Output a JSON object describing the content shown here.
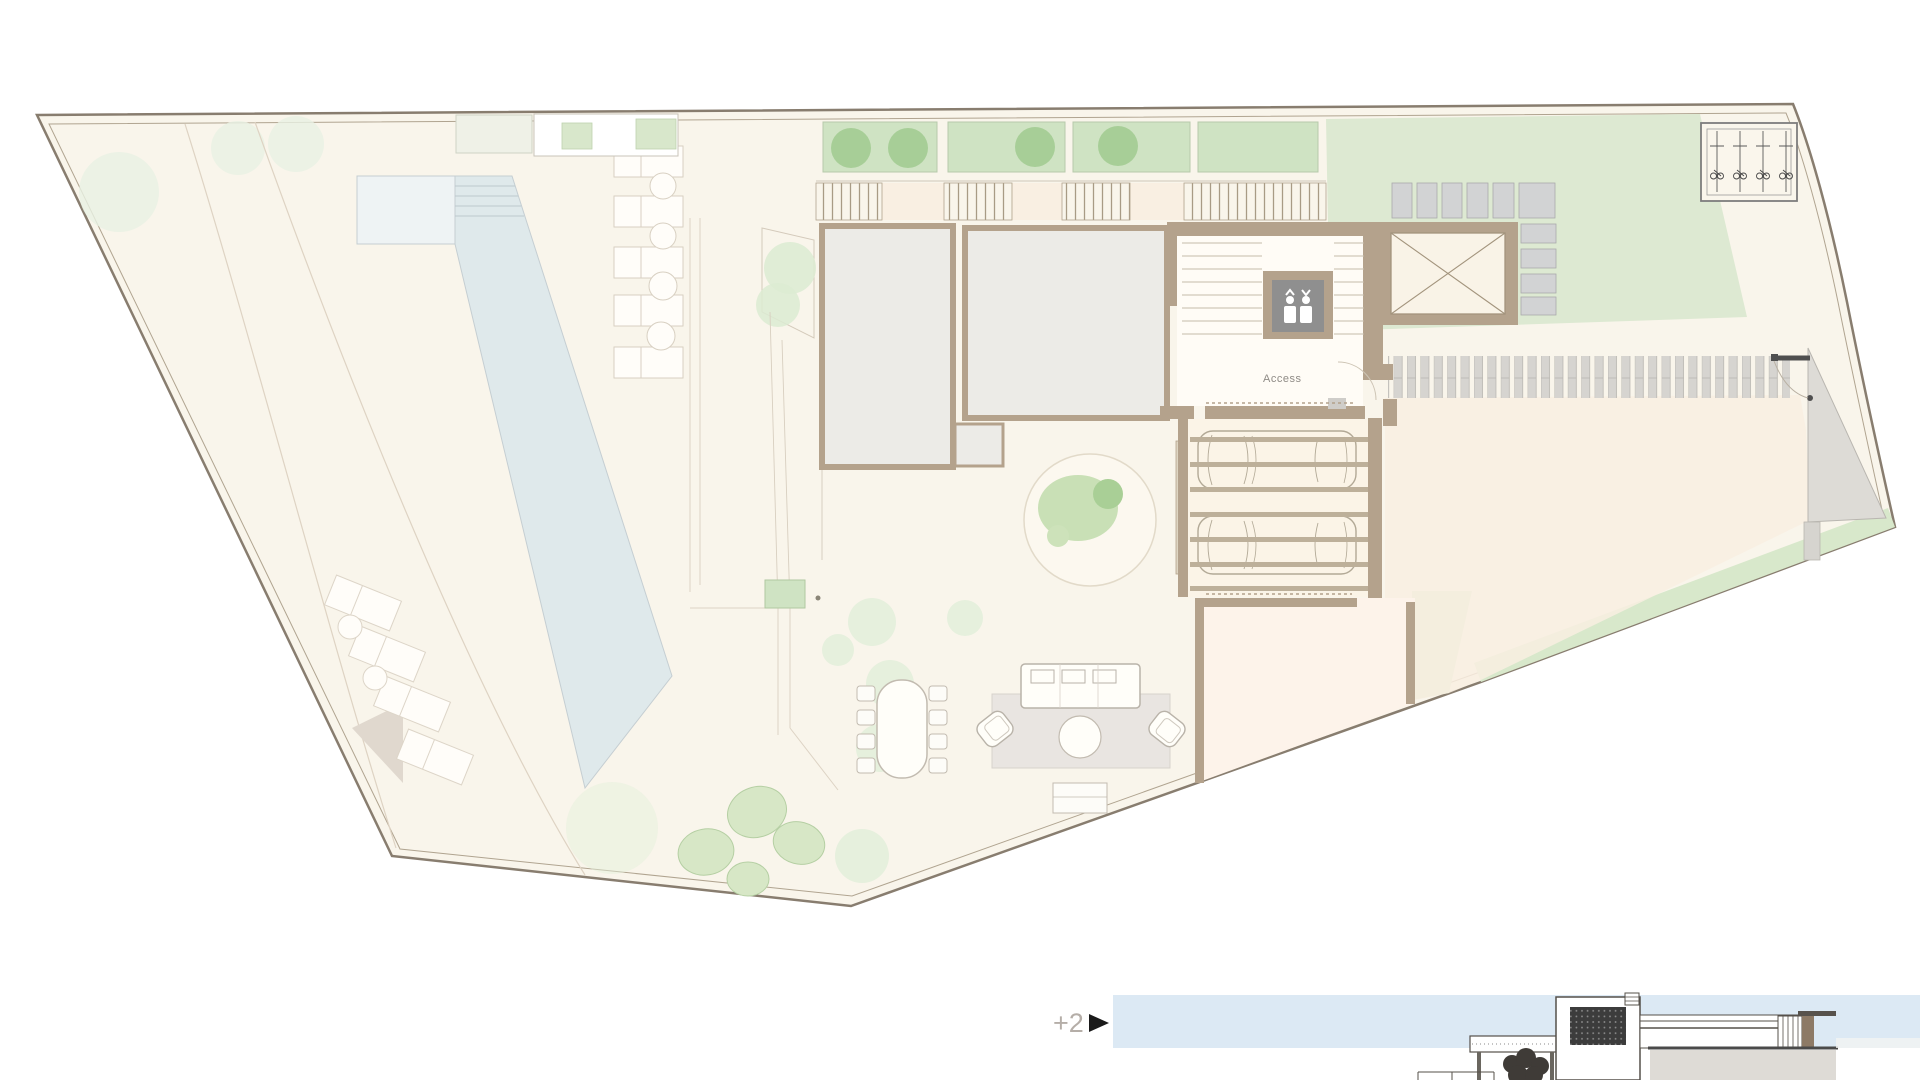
{
  "document": {
    "type": "architectural-site-plan",
    "sheet": "ground floor plan with pool, garden, garage and partial side elevation"
  },
  "plan": {
    "access_label": "Access"
  },
  "elevation": {
    "level_label": "+2"
  },
  "icons": [
    "elevator-people-icon",
    "bicycle-rack-icon",
    "car-icon",
    "gate-icon",
    "door-swing-arc-icon",
    "right-triangle-level-marker-icon",
    "tree-icon",
    "shrub-icon",
    "crossed-void-icon"
  ],
  "palette": {
    "page_bg": "#ffffff",
    "site_fill": "#f9f5eb",
    "boundary": "#8a7e6f",
    "boundary_inner": "#b0a490",
    "wall_tan": "#b4a28c",
    "room_gray": "#ecebe7",
    "pool_blue": "#dfe9eb",
    "pool_shallow": "#eef3f4",
    "planter_green": "#cfe3c3",
    "tree_green": "#a3cc93",
    "lawn_green": "#dde9d2",
    "paver_gray": "#d6d4d0",
    "peach": "#f9efe2",
    "room_peach": "#fdf3ea",
    "rug_gray": "#e9e5e1",
    "elevator_gray": "#8f8f8f",
    "sky_blue": "#dce9f4",
    "elevation_dark": "#3c3c3c",
    "text_gray": "#8f8b86",
    "marker_black": "#1a1a1a"
  }
}
